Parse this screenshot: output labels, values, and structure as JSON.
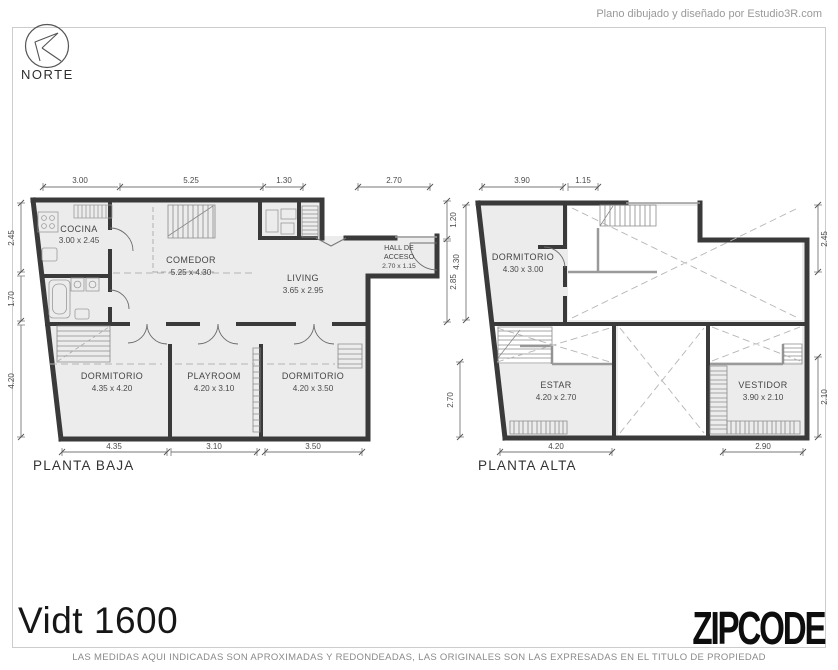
{
  "header": {
    "credit": "Plano dibujado y diseñado por Estudio3R.com",
    "north_label": "NORTE"
  },
  "plans": {
    "baja": {
      "title": "PLANTA BAJA",
      "rooms": [
        {
          "name": "COCINA",
          "dims": "3.00 x 2.45"
        },
        {
          "name": "COMEDOR",
          "dims": "5.25 x 4.30"
        },
        {
          "name": "LIVING",
          "dims": "3.65 x 2.95"
        },
        {
          "name": "HALL DE",
          "name_line2": "ACCESO",
          "dims": "2.70 x 1.15"
        },
        {
          "name": "DORMITORIO",
          "dims": "4.35 x 4.20"
        },
        {
          "name": "PLAYROOM",
          "dims": "4.20 x 3.10"
        },
        {
          "name": "DORMITORIO",
          "dims": "4.20 x 3.50"
        }
      ],
      "dims_top": [
        "3.00",
        "5.25",
        "1.30",
        "2.70"
      ],
      "dims_bottom": [
        "4.35",
        "3.10",
        "3.50"
      ],
      "dims_left": [
        "2.45",
        "1.70",
        "4.20"
      ],
      "dims_right": [
        "1.20",
        "2.85"
      ]
    },
    "alta": {
      "title": "PLANTA ALTA",
      "rooms": [
        {
          "name": "DORMITORIO",
          "dims": "4.30 x 3.00"
        },
        {
          "name": "ESTAR",
          "dims": "4.20 x 2.70"
        },
        {
          "name": "VESTIDOR",
          "dims": "3.90 x 2.10"
        }
      ],
      "dims_top": [
        "3.90",
        "1.15"
      ],
      "dims_bottom": [
        "4.20",
        "2.90"
      ],
      "dims_left": [
        "4.30",
        "2.70"
      ],
      "dims_right": [
        "2.45",
        "2.10"
      ]
    }
  },
  "footer": {
    "address": "Vidt 1600",
    "brand": "ZIPCODE",
    "disclaimer": "LAS MEDIDAS AQUI INDICADAS SON APROXIMADAS Y REDONDEADAS, LAS ORIGINALES SON LAS EXPRESADAS EN EL TITULO DE PROPIEDAD"
  },
  "colors": {
    "wall": "#3a3a3a",
    "floor_fill": "#ececec",
    "dim_text": "#4a4a4a",
    "frame": "#cccccc",
    "brand_text": "#0d0d0d"
  }
}
